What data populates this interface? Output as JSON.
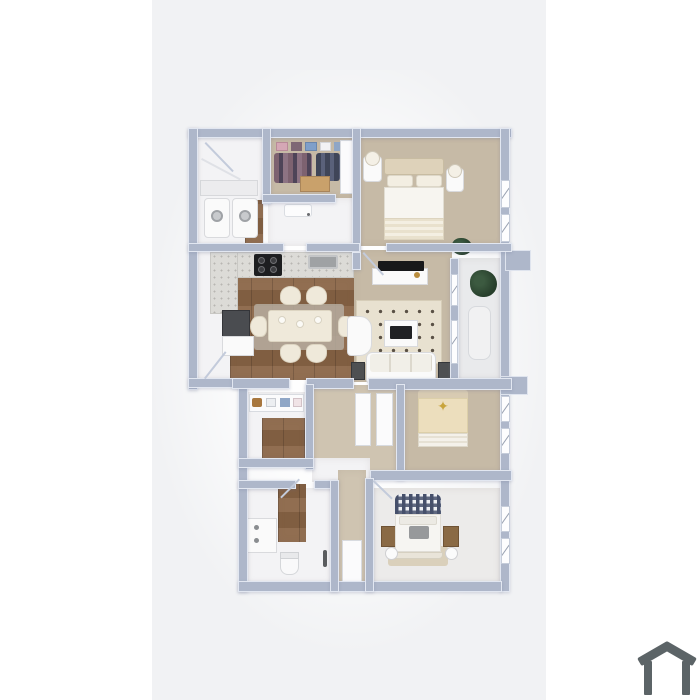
{
  "scene": {
    "type": "3d-floor-plan-render",
    "description": "Top-down 3D rendered floor plan of a multi-room apartment on a light vertical canvas, with a house logo watermark at bottom right",
    "text_visible": "none"
  },
  "colors": {
    "bg": "#ffffff",
    "canvas": "#f1f2f4",
    "wall": "#aeb7ca",
    "floorwhite": "#f3f3f5",
    "floortan": "#c6baa6",
    "wood": "#8a6546",
    "logo": "#5c6467"
  },
  "floorplan": {
    "rooms": [
      {
        "name": "entry-laundry",
        "floor": "white",
        "furniture": [
          "coat-closet-shelf",
          "washer",
          "dryer",
          "entry-door-swing"
        ]
      },
      {
        "name": "walk-in-closet",
        "floor": "tan",
        "furniture": [
          "storage-boxes",
          "hanging-clothes",
          "dresser",
          "shelf-unit"
        ]
      },
      {
        "name": "hallway-upper",
        "floor": "white",
        "furniture": [
          "open-door"
        ]
      },
      {
        "name": "bedroom-master",
        "floor": "tan",
        "furniture": [
          "bed",
          "headboard",
          "pillows",
          "nightstand-left",
          "nightstand-right",
          "lamps",
          "plant",
          "windows"
        ]
      },
      {
        "name": "kitchen-dining",
        "floor": "wood",
        "furniture": [
          "l-counter-marble",
          "cooktop",
          "sink",
          "dark-cabinet",
          "dining-table",
          "six-chairs",
          "rug"
        ]
      },
      {
        "name": "living-room",
        "floor": "tan",
        "furniture": [
          "tv-console",
          "tv",
          "dotted-rug",
          "coffee-table",
          "armchair",
          "sofa",
          "speaker-left",
          "speaker-right"
        ]
      },
      {
        "name": "balcony",
        "floor": "light",
        "furniture": [
          "plant",
          "lounge-chair",
          "ac-unit"
        ]
      },
      {
        "name": "dressing-closet",
        "floor": "white-wood",
        "furniture": [
          "shelf-with-boxes"
        ]
      },
      {
        "name": "hall-linen",
        "floor": "tan",
        "furniture": [
          "linen-shelf-1",
          "linen-shelf-2",
          "linen-shelf-small"
        ]
      },
      {
        "name": "bedroom-2",
        "floor": "tan",
        "furniture": [
          "bed-star-blanket",
          "windows"
        ]
      },
      {
        "name": "bathroom",
        "floor": "white",
        "furniture": [
          "vanity-sink",
          "toilet",
          "accessory-stand"
        ]
      },
      {
        "name": "bedroom-3",
        "floor": "light",
        "furniture": [
          "bed-gingham",
          "gray-cushion",
          "rug",
          "nightstand-left",
          "nightstand-right",
          "lamps",
          "windows"
        ]
      }
    ]
  },
  "logo": {
    "icon": "house-icon",
    "color": "#5c6467"
  }
}
